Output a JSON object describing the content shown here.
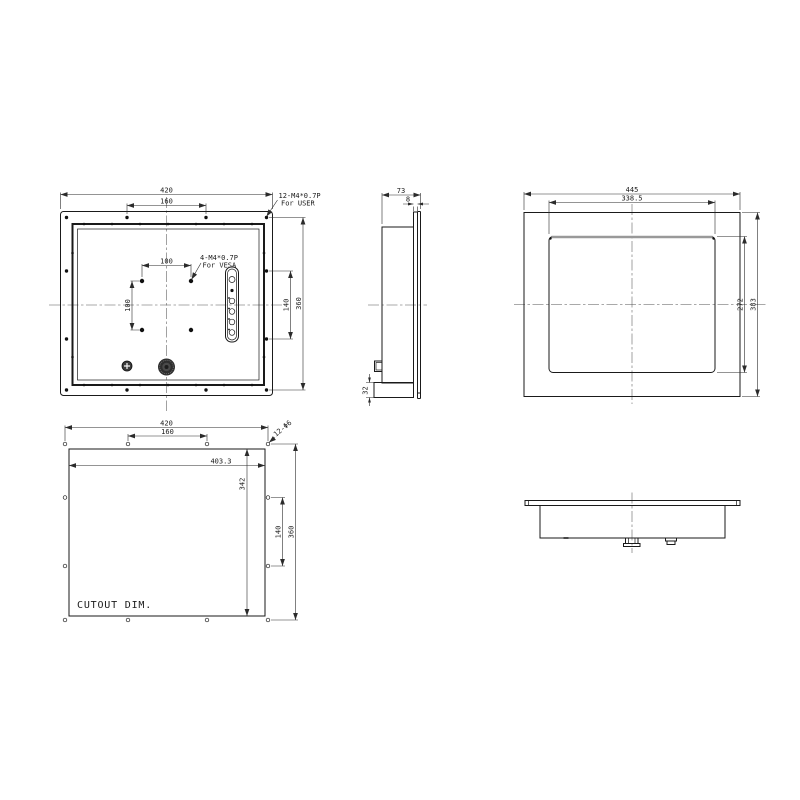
{
  "drawing": {
    "kind": "panel-mount-monitor-dimension-drawing"
  },
  "views": {
    "rear": {
      "dim_overall_width": "420",
      "dim_mount_hole_spacing_h": "160",
      "dim_vesa_width": "100",
      "dim_vesa_height": "100",
      "dim_mount_hole_spacing_v": "140",
      "dim_overall_height": "360",
      "label_user_thread": "12-M4*0.7P",
      "label_user_for": "For USER",
      "label_vesa_thread": "4-M4*0.7P",
      "label_vesa_for": "For VESA"
    },
    "side": {
      "dim_total_depth": "73",
      "dim_front_frame_depth": "8",
      "dim_bottom_section": "32"
    },
    "front": {
      "dim_overall_width": "445",
      "dim_display_width": "338.5",
      "dim_display_height": "272",
      "dim_overall_height": "383"
    },
    "cutout": {
      "dim_hole_span_width": "420",
      "dim_hole_spacing_h": "160",
      "dim_cutout_width": "403.3",
      "dim_cutout_height": "342",
      "dim_hole_spacing_v": "140",
      "dim_hole_span_height": "360",
      "label_holes": "12-Φ6",
      "caption": "CUTOUT DIM."
    }
  },
  "colors": {
    "line": "#1a1a1a",
    "dim_line": "#2b2b2b",
    "centerline": "#555555",
    "screen_top_edge": "#999999",
    "background": "#ffffff"
  }
}
